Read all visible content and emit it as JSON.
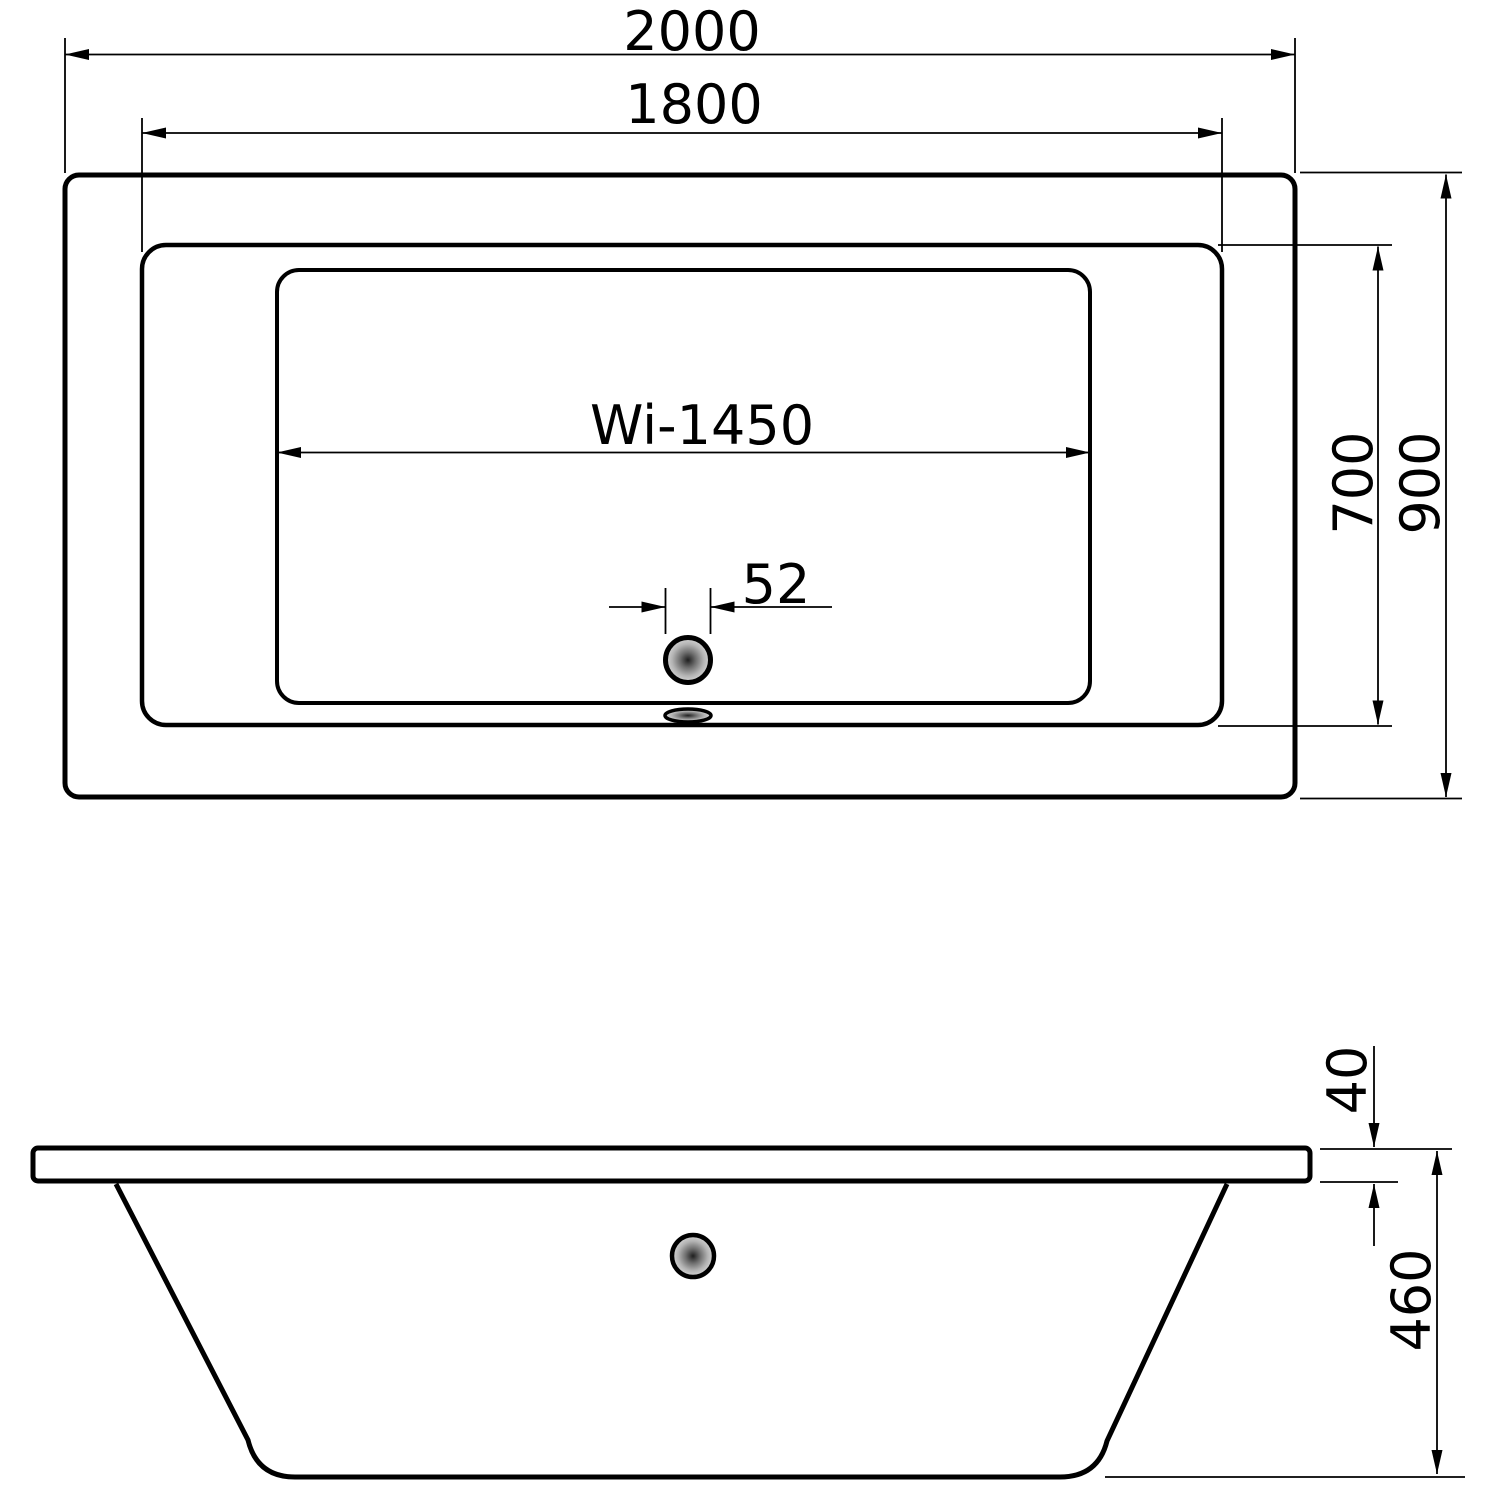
{
  "document": {
    "type": "technical-drawing",
    "subject": "bathtub dimensions, plan view and side elevation",
    "views": [
      "top-plan-view",
      "side-elevation-view"
    ]
  },
  "colors": {
    "background": "#ffffff",
    "line": "#000000",
    "drain_center": "#1f1f1f",
    "drain_mid": "#8a8a8a",
    "drain_edge": "#d8d8d8"
  },
  "top_view": {
    "labels": {
      "overall_length": "2000",
      "rim_inner_length": "1800",
      "interior_length": "Wi-1450",
      "drain_diameter": "52",
      "interior_width": "700",
      "overall_width": "900"
    }
  },
  "side_view": {
    "labels": {
      "rim_thickness": "40",
      "height": "460"
    }
  }
}
